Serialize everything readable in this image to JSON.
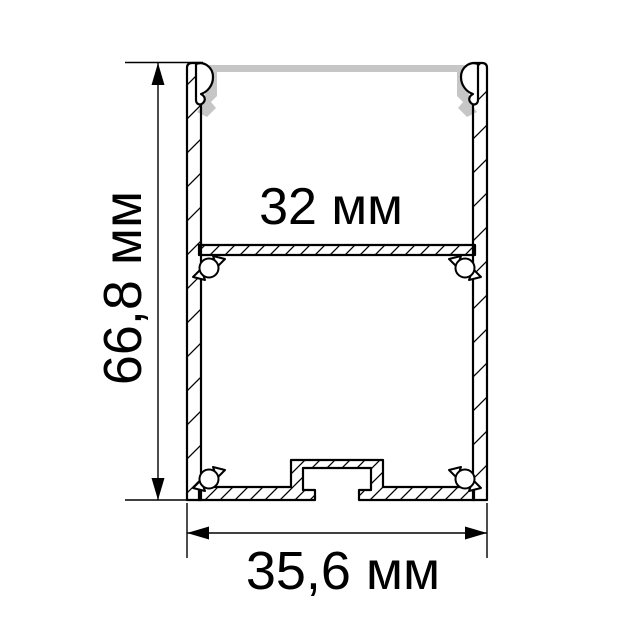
{
  "drawing": {
    "colors": {
      "outline": "#000000",
      "diffuser": "#c6c6c6",
      "background": "#ffffff"
    },
    "dimensions": {
      "height_label": "66,8 мм",
      "inner_width_label": "32 мм",
      "outer_width_label": "35,6 мм"
    }
  }
}
